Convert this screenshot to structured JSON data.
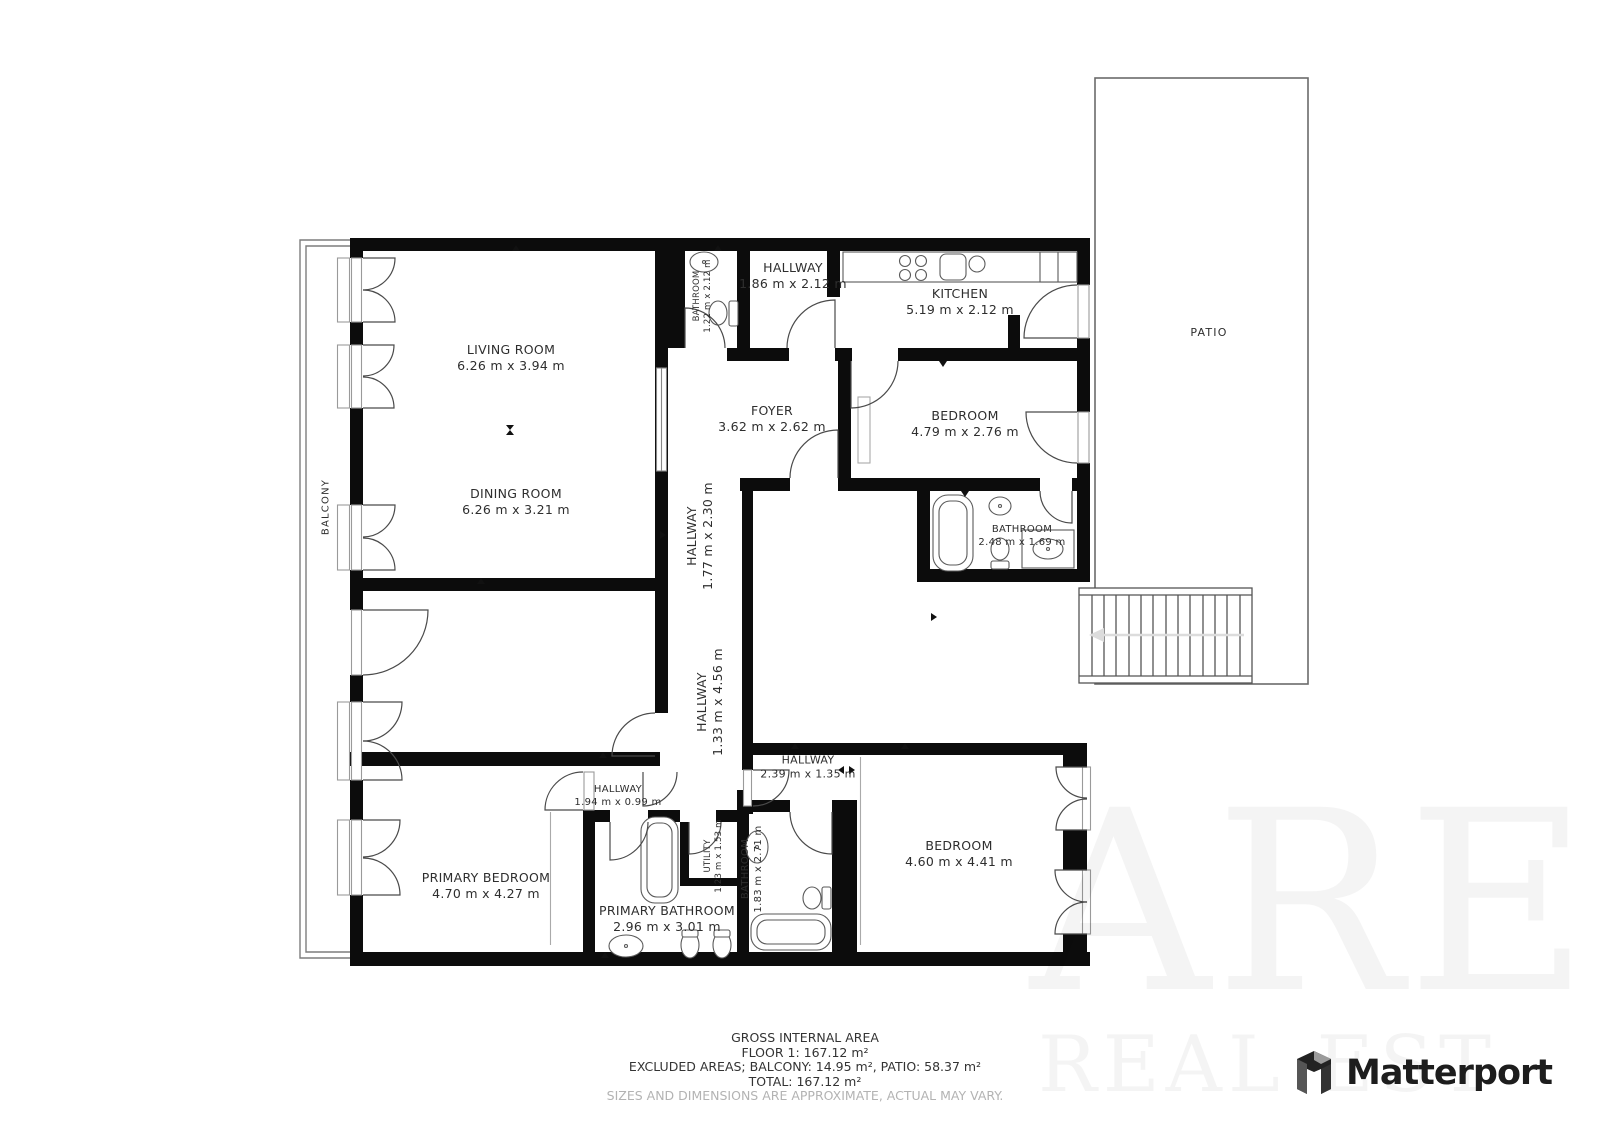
{
  "rooms": {
    "living_room": {
      "name": "LIVING ROOM",
      "dims": "6.26 m x 3.94 m"
    },
    "dining_room": {
      "name": "DINING ROOM",
      "dims": "6.26 m x 3.21 m"
    },
    "bathroom_small": {
      "name": "BATHROOM",
      "dims": "1.22 m x 2.12 m"
    },
    "hallway_top": {
      "name": "HALLWAY",
      "dims": "1.86 m x 2.12 m"
    },
    "kitchen": {
      "name": "KITCHEN",
      "dims": "5.19 m x 2.12 m"
    },
    "foyer": {
      "name": "FOYER",
      "dims": "3.62 m x 2.62 m"
    },
    "bedroom_top": {
      "name": "BEDROOM",
      "dims": "4.79 m x 2.76 m"
    },
    "bathroom_ensuite": {
      "name": "BATHROOM",
      "dims": "2.48 m x 1.69 m"
    },
    "hallway_upper": {
      "name": "HALLWAY",
      "dims": "1.77 m x 2.30 m"
    },
    "hallway_main": {
      "name": "HALLWAY",
      "dims": "1.33 m x 4.56 m"
    },
    "hallway_lower": {
      "name": "HALLWAY",
      "dims": "2.39 m x 1.35 m"
    },
    "hallway_small": {
      "name": "HALLWAY",
      "dims": "1.94 m x 0.99 m"
    },
    "primary_bedroom": {
      "name": "PRIMARY BEDROOM",
      "dims": "4.70 m x 4.27 m"
    },
    "primary_bathroom": {
      "name": "PRIMARY BATHROOM",
      "dims": "2.96 m x 3.01 m"
    },
    "utility": {
      "name": "UTILITY",
      "dims": "1.23 m x 1.53 m"
    },
    "bathroom_lower": {
      "name": "BATHROOM",
      "dims": "1.83 m x 2.71 m"
    },
    "bedroom_lower": {
      "name": "BEDROOM",
      "dims": "4.60 m x 4.41 m"
    }
  },
  "outdoor": {
    "balcony": "BALCONY",
    "patio": "PATIO"
  },
  "footer": {
    "title": "GROSS INTERNAL AREA",
    "floor": "FLOOR 1: 167.12 m²",
    "excluded": "EXCLUDED AREAS; BALCONY: 14.95 m², PATIO: 58.37 m²",
    "total": "TOTAL: 167.12 m²",
    "disclaimer": "SIZES AND DIMENSIONS ARE APPROXIMATE, ACTUAL MAY VARY."
  },
  "branding": {
    "logo_text": "Matterport"
  },
  "watermark": {
    "line1": "ARE",
    "line2": "REAL EST"
  }
}
